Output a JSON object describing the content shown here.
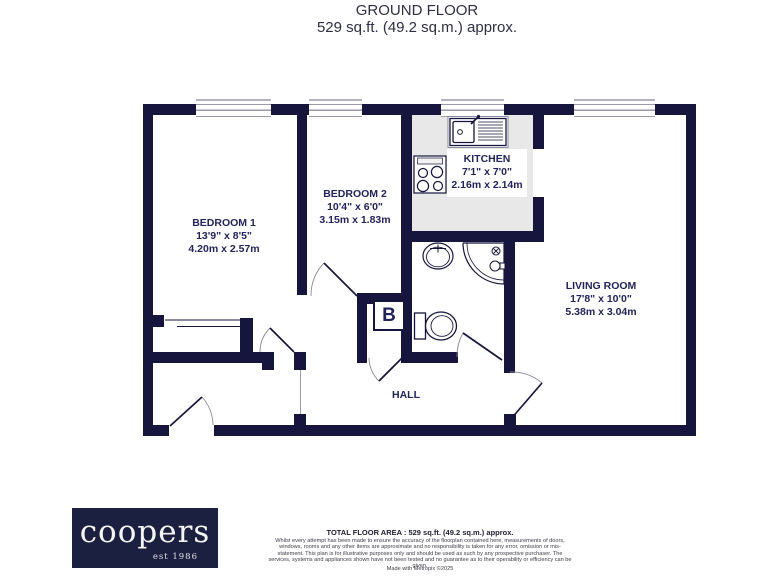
{
  "title": {
    "line1": "GROUND FLOOR",
    "line2": "529 sq.ft. (49.2 sq.m.) approx."
  },
  "rooms": [
    {
      "name": "BEDROOM 1",
      "imperial": "13'9\"  x 8'5\"",
      "metric": "4.20m  x 2.57m"
    },
    {
      "name": "BEDROOM 2",
      "imperial": "10'4\"  x 6'0\"",
      "metric": "3.15m  x 1.83m"
    },
    {
      "name": "KITCHEN",
      "imperial": "7'1\"  x 7'0\"",
      "metric": "2.16m  x 2.14m"
    },
    {
      "name": "LIVING ROOM",
      "imperial": "17'8\"  x 10'0\"",
      "metric": "5.38m  x 3.04m"
    },
    {
      "name": "HALL"
    }
  ],
  "labels": {
    "boiler": "B"
  },
  "logo": {
    "name": "coopers",
    "est": "est 1986"
  },
  "footer": {
    "total": "TOTAL FLOOR AREA : 529 sq.ft. (49.2 sq.m.) approx.",
    "disclaimer": "Whilst every attempt has been made to ensure the accuracy of the floorplan contained here, measurements of doors, windows, rooms and any other items are approximate and no responsibility is taken for any error, omission or mis-statement. This plan is for illustrative purposes only and should be used as such by any prospective purchaser. The services, systems and appliances shown have not been tested and no guarantee as to their operability or efficiency can be given.",
    "credit": "Made with Metropix ©2025"
  },
  "colors": {
    "wall": "#15153d",
    "text": "#23235c",
    "kitchen_floor": "#e8e8e8",
    "logo_bg": "#1b2040"
  }
}
